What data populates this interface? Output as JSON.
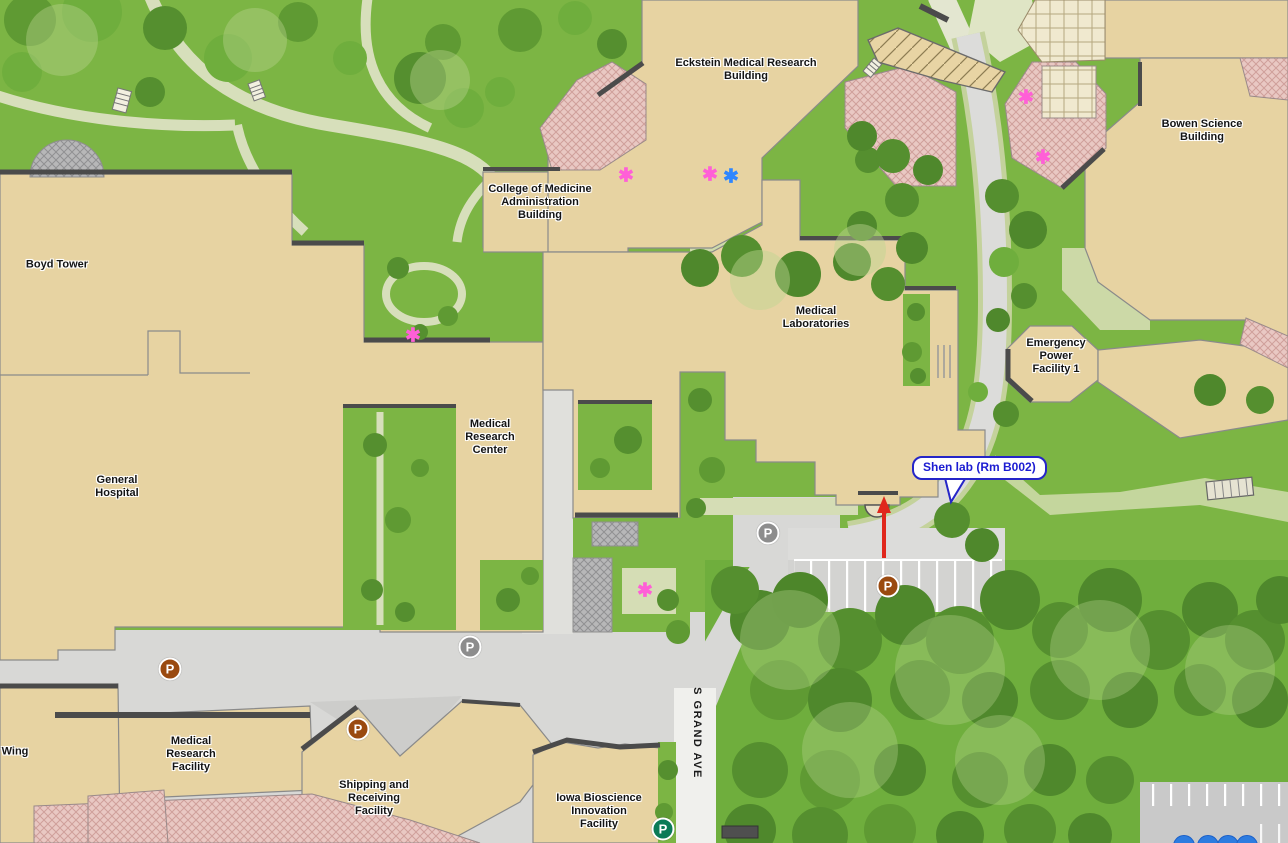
{
  "map": {
    "labels": {
      "boyd_tower": "Boyd Tower",
      "general_hospital": "General Hospital",
      "eckstein": "Eckstein Medical Research Building",
      "college_of_medicine": "College of Medicine Administration Building",
      "bowen": "Bowen Science Building",
      "medical_laboratories": "Medical Laboratories",
      "emergency_power": "Emergency Power Facility 1",
      "medical_research_center": "Medical Research Center",
      "medical_research_facility": "Medical Research Facility",
      "shipping_receiving": "Shipping and Receiving Facility",
      "iowa_bioscience": "Iowa Bioscience Innovation Facility",
      "wing": "Wing",
      "s_grand_ave": "S GRAND AVE"
    },
    "callout": {
      "text": "Shen lab (Rm B002)",
      "border_color": "#2525c8",
      "text_color": "#1c1cd2"
    },
    "route_arrow": {
      "x": 884,
      "from_y": 558,
      "to_y": 500,
      "color": "#e0271c"
    },
    "markers": {
      "asterisk_glyph": "✱",
      "items": [
        {
          "x": 626,
          "y": 176,
          "color": "#ff5fd7",
          "kind": "pink-asterisk"
        },
        {
          "x": 710,
          "y": 175,
          "color": "#ff5fd7",
          "kind": "pink-asterisk"
        },
        {
          "x": 731,
          "y": 177,
          "color": "#2e86ff",
          "kind": "blue-asterisk"
        },
        {
          "x": 413,
          "y": 336,
          "color": "#ff5fd7",
          "kind": "pink-asterisk"
        },
        {
          "x": 645,
          "y": 591,
          "color": "#ff5fd7",
          "kind": "pink-asterisk"
        },
        {
          "x": 1026,
          "y": 98,
          "color": "#ff5fd7",
          "kind": "pink-asterisk"
        },
        {
          "x": 1043,
          "y": 158,
          "color": "#ff5fd7",
          "kind": "pink-asterisk"
        }
      ]
    },
    "parking": {
      "glyph": "P",
      "variants": {
        "public": "#9a4a10",
        "restricted": "#8d8d8d",
        "accessible": "#0b7b57"
      },
      "items": [
        {
          "x": 170,
          "y": 669,
          "variant": "public"
        },
        {
          "x": 358,
          "y": 729,
          "variant": "public"
        },
        {
          "x": 888,
          "y": 586,
          "variant": "public"
        },
        {
          "x": 768,
          "y": 533,
          "variant": "restricted"
        },
        {
          "x": 470,
          "y": 647,
          "variant": "restricted"
        },
        {
          "x": 663,
          "y": 829,
          "variant": "accessible"
        }
      ]
    },
    "bottom_buttons": [
      {
        "x": 1184
      },
      {
        "x": 1208
      },
      {
        "x": 1228
      },
      {
        "x": 1247
      }
    ],
    "colors": {
      "building": "#e7d3a2",
      "grass": "#7cb544",
      "forest_tree": "#4f882c",
      "road": "#d8d8d6",
      "path": "#ccd9a7",
      "plaza_pink": "#e9c8c3",
      "plaza_gray": "#b7b7b8",
      "street_white": "#f0f0ed"
    }
  }
}
